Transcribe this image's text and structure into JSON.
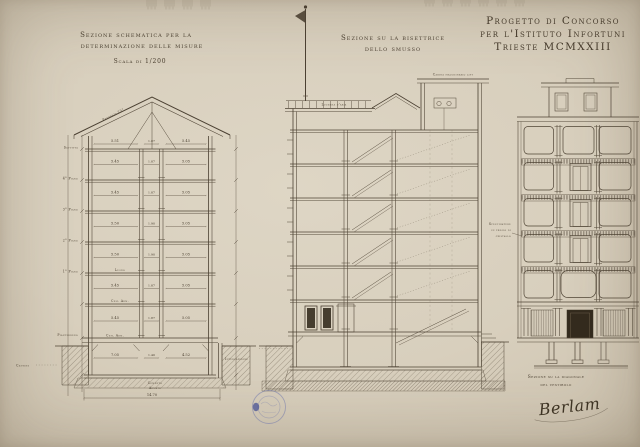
{
  "header": {
    "line1": "Progetto di Concorso",
    "line2": "per l'Istituto Infortuni",
    "line3": "Trieste MCMXXIII"
  },
  "left": {
    "title_line1": "Sezione schematica per la",
    "title_line2": "determinazione delle misure",
    "scale": "Scala di 1/200",
    "roof_note": "Pendenza 25°",
    "floor_labels": [
      "Soffitta",
      "4° Piano",
      "3° Piano",
      "2° Piano",
      "1° Piano",
      "Pianterreno",
      "Cantine"
    ],
    "materials": {
      "wood": "Legno",
      "concrete": "Cem. Arm."
    },
    "rows": [
      [
        "5.51",
        "1.87",
        "5.45"
      ],
      [
        "5.45",
        "1.87",
        "5.05"
      ],
      [
        "5.45",
        "1.87",
        "5.05"
      ],
      [
        "5.50",
        "1.90",
        "5.05"
      ],
      [
        "5.50",
        "1.90",
        "5.05"
      ],
      [
        "5.45",
        "1.87",
        "5.05"
      ],
      [
        "5.45",
        "1.87",
        "5.05"
      ],
      [
        "7.05",
        "1.40",
        "4.52"
      ]
    ],
    "total_width": "14.70",
    "footing_label_line1": "Cemento",
    "footing_label_line2": "Armato",
    "right_note": "Intercapedine"
  },
  "middle": {
    "title_line1": "Sezione su la bisettrice",
    "title_line2": "dello smusso",
    "lift_cabin_label": "Cabina macchinario lift",
    "skylight_label": "Lucerna d'aria"
  },
  "right": {
    "title_line1": "Sezione su la diagonale",
    "title_line2": "del vestibolo",
    "glass_note_line1": "Specchiature",
    "glass_note_line2": "in fregio di",
    "glass_note_line3": "cristallo",
    "signature": "Berlam"
  },
  "colors": {
    "paper": "#d8cfbd",
    "ink": "#4b4032",
    "stamp_blue": "#6b73ab"
  }
}
